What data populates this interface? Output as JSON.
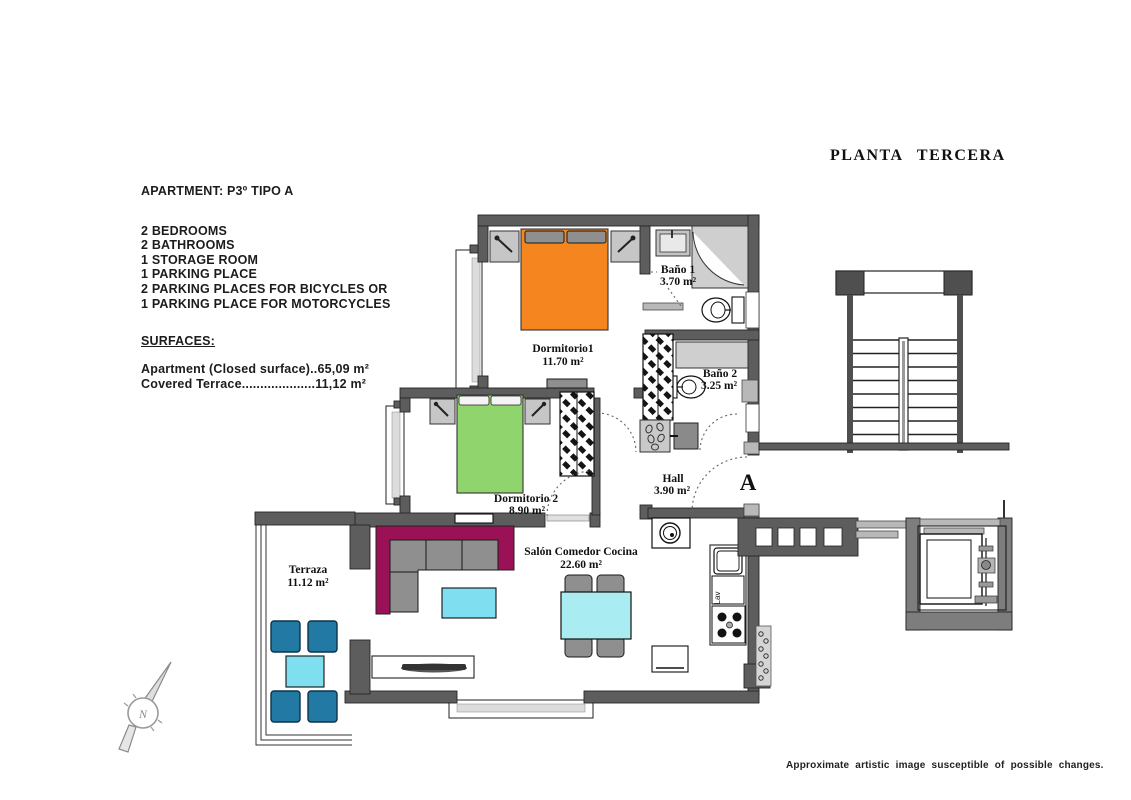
{
  "header": {
    "title": "PLANTA TERCERA"
  },
  "footer": {
    "disclaimer": "Approximate artistic image susceptible of possible changes."
  },
  "info": {
    "apartment": "APARTMENT: P3º TIPO A",
    "features": [
      "2 BEDROOMS",
      "2 BATHROOMS",
      "1 STORAGE ROOM",
      "1 PARKING PLACE",
      "2 PARKING PLACES FOR BICYCLES OR",
      "1 PARKING PLACE FOR MOTORCYCLES"
    ],
    "surfaces_heading": "SURFACES:",
    "surfaces": [
      "Apartment (Closed surface)..65,09 m²",
      "Covered Terrace....................11,12 m²"
    ]
  },
  "plan": {
    "rooms": {
      "dormitorio1": {
        "name": "Dormitorio1",
        "area": "11.70 m²"
      },
      "dormitorio2": {
        "name": "Dormitorio 2",
        "area": "8.90 m²"
      },
      "bano1": {
        "name": "Baño 1",
        "area": "3.70 m²"
      },
      "bano2": {
        "name": "Baño 2",
        "area": "3.25 m²"
      },
      "salon": {
        "name": "Salón Comedor Cocina",
        "area": "22.60 m²"
      },
      "hall": {
        "name": "Hall",
        "area": "3.90 m²"
      },
      "terraza": {
        "name": "Terraza",
        "area": "11.12 m²"
      }
    },
    "entrance_label": "A",
    "compass_label": "N",
    "kitchen_cabinet_label": "Lav",
    "colors": {
      "bed_orange": "#f5861f",
      "bed_green": "#8fd46c",
      "sofa_maroon": "#9b1155",
      "table_cyan": "#7fdef0",
      "dining_table_cyan": "#a9ecf2",
      "chair_blue": "#2279a4",
      "wall_dark": "#5d5d5d",
      "wall_light": "#b8b8b8"
    }
  }
}
